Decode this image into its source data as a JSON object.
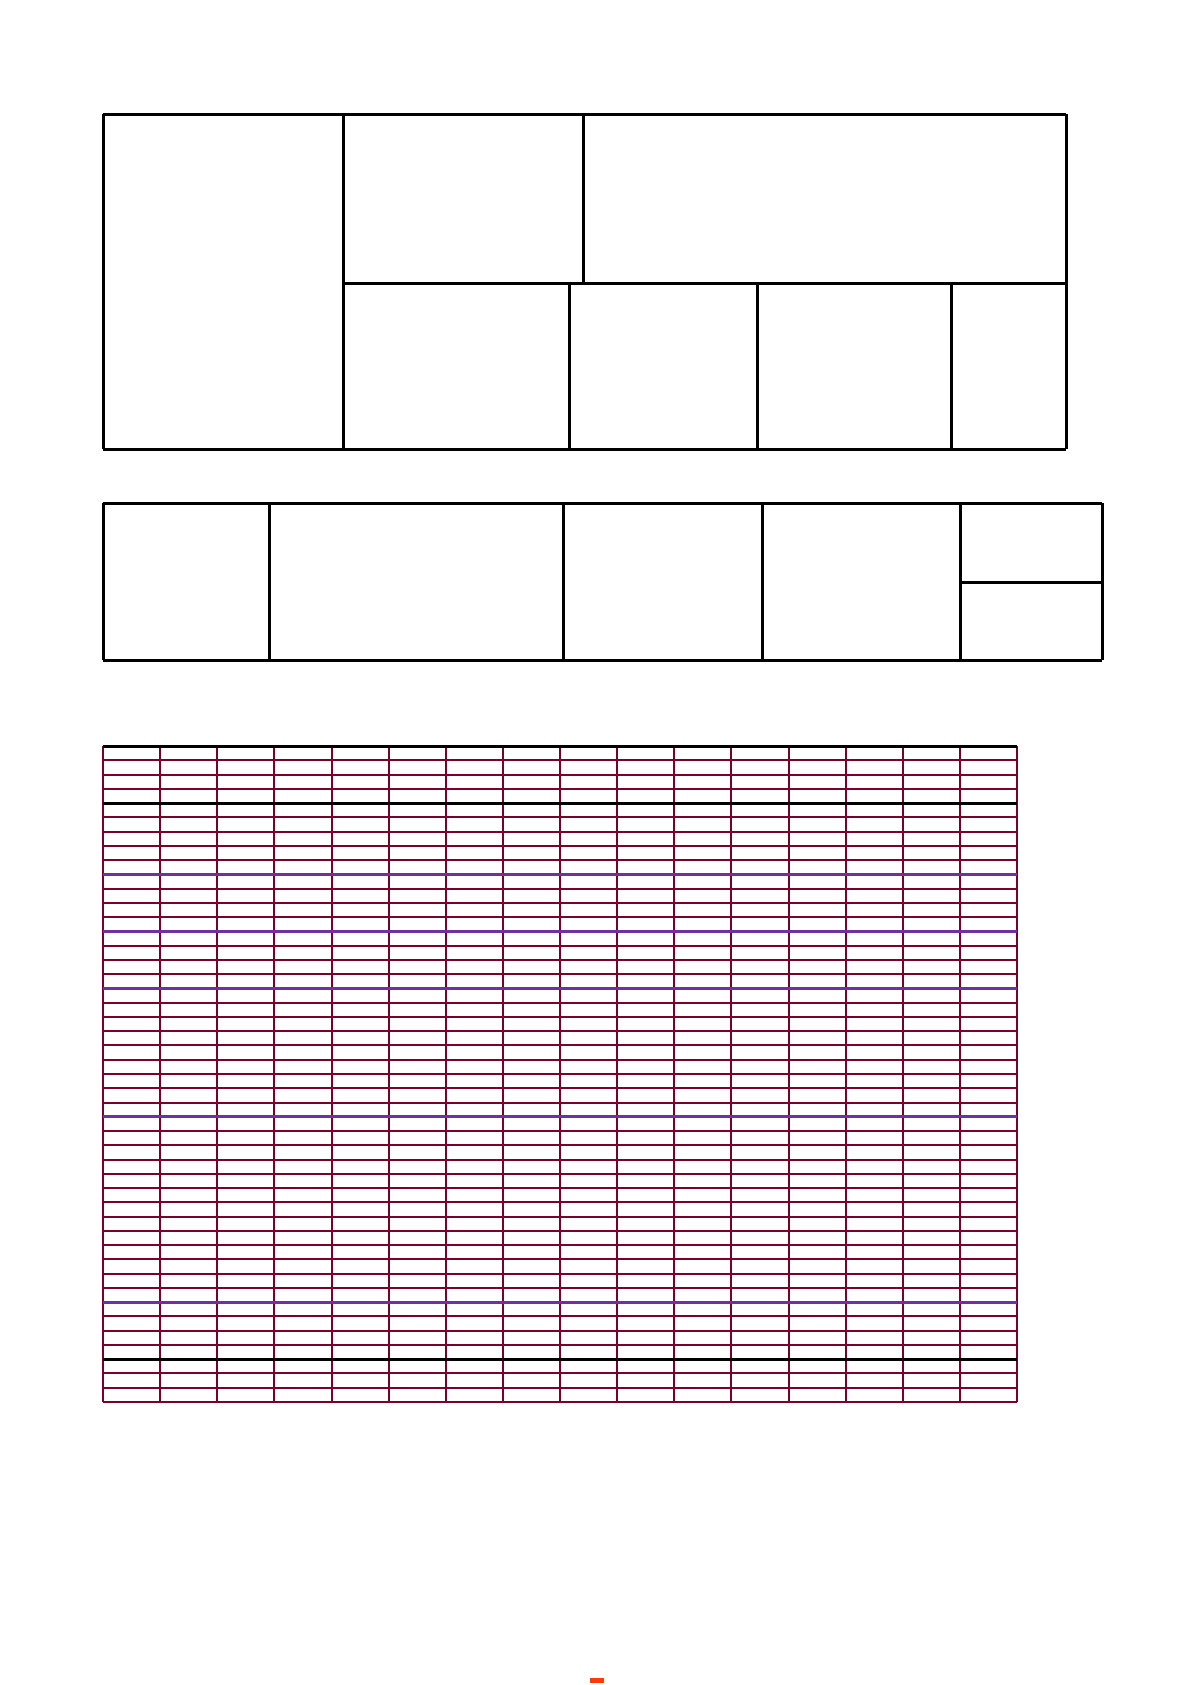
{
  "page": {
    "width_px": 1191,
    "height_px": 1685,
    "background": "#ffffff"
  },
  "colors": {
    "form_border": "#000000",
    "grid_line": "#7a0029",
    "grid_accent_purple": "#7030a0",
    "grid_accent_black": "#000000",
    "footer_mark_red": "#fb3a0e"
  },
  "header_form": {
    "description": "empty bordered form, top-left of page, all cells blank",
    "x_left": 103,
    "x_right": 1066,
    "y_top": 114,
    "y_bottom": 449,
    "row_divider_y": 283,
    "left_column_divider_x": 343,
    "top_row_divider_x": 583,
    "bottom_row_dividers_x": [
      569,
      757,
      951
    ],
    "stroke_px": 3
  },
  "info_table": {
    "description": "empty bordered one-row table with split last column, all cells blank",
    "x_left": 103,
    "x_right": 1102,
    "y_top": 503,
    "y_bottom": 660,
    "column_dividers_x": [
      269,
      563,
      762,
      960
    ],
    "last_column_split_y": 582,
    "last_column_left_x": 960,
    "stroke_px": 3
  },
  "ruled_grid": {
    "description": "blank ruled writing grid, dark-red lines, black top border, all cells empty",
    "x_left": 103,
    "x_right": 1017,
    "y_top": 746,
    "y_bottom": 1402,
    "columns": 16,
    "rows": 46,
    "black_row_boundaries": [
      4,
      43
    ],
    "purple_row_boundaries": [
      9,
      13,
      17,
      26,
      39
    ],
    "regular_stroke_px": 2,
    "accent_stroke_px": 3,
    "top_border_stroke_px": 3
  },
  "footer_mark": {
    "description": "small red mark clipped at bottom page edge",
    "x": 590,
    "y": 1678,
    "width": 14,
    "height": 5
  }
}
